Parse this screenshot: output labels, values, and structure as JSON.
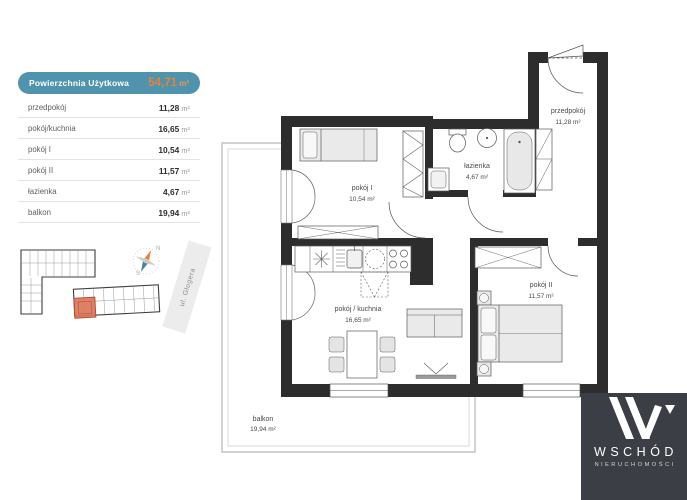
{
  "colors": {
    "accent_teal": "#4f94ac",
    "accent_orange": "#e8803c",
    "wall": "#2d2d2d",
    "logo_background": "#3b3e44",
    "highlighted_unit": "#db7356"
  },
  "area_table": {
    "header_label": "Powierzchnia Użytkowa",
    "header_value": "54,71",
    "unit_display": " m²",
    "rows": [
      {
        "label": "przedpokój",
        "value": "11,28"
      },
      {
        "label": "pokój/kuchnia",
        "value": "16,65"
      },
      {
        "label": "pokój I",
        "value": "10,54"
      },
      {
        "label": "pokój II",
        "value": "11,57"
      },
      {
        "label": "łazienka",
        "value": "4,67"
      },
      {
        "label": "balkon",
        "value": "19,94"
      }
    ]
  },
  "site_plan": {
    "street_label": "ul. Głogera",
    "north_label": "N",
    "south_label": "S"
  },
  "floor_plan": {
    "rooms": [
      {
        "name": "pokój I",
        "area": "10,54 m²"
      },
      {
        "name": "łazienka",
        "area": "4,67 m²"
      },
      {
        "name": "przedpokój",
        "area": "11,28 m²"
      },
      {
        "name": "pokój / kuchnia",
        "area": "16,65 m²"
      },
      {
        "name": "pokój II",
        "area": "11,57 m²"
      },
      {
        "name": "balkon",
        "area": "19,94 m²"
      }
    ]
  },
  "logo": {
    "brand": "WSCHÓD",
    "subtitle": "NIERUCHOMOŚCI"
  }
}
